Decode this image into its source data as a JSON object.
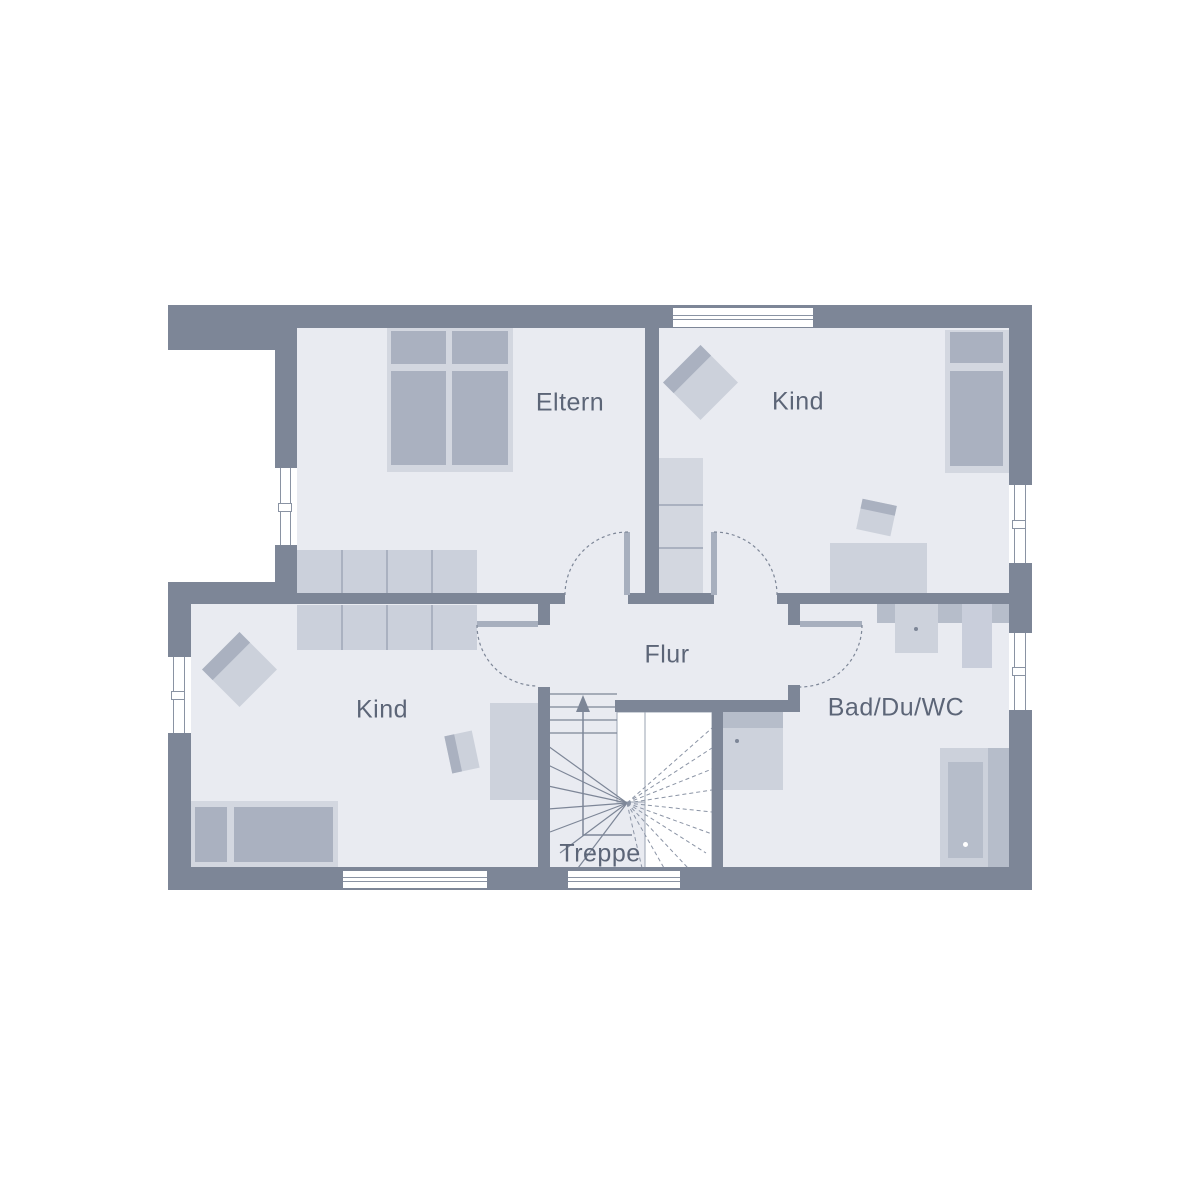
{
  "plan": {
    "type": "floor-plan",
    "rooms": {
      "eltern": {
        "label": "Eltern"
      },
      "kind_top": {
        "label": "Kind"
      },
      "kind_bottom": {
        "label": "Kind"
      },
      "flur": {
        "label": "Flur"
      },
      "bad": {
        "label": "Bad/Du/WC"
      },
      "treppe": {
        "label": "Treppe"
      }
    },
    "furniture": {
      "eltern": [
        "double-bed",
        "wardrobe"
      ],
      "kind_top": [
        "lounge-chair",
        "shelf",
        "single-bed",
        "desk",
        "desk-chair"
      ],
      "kind_bottom": [
        "wardrobe",
        "lounge-chair",
        "single-bed",
        "desk",
        "desk-chair"
      ],
      "bad": [
        "vanity-counter",
        "washbasin",
        "shower-column",
        "wc",
        "bathtub"
      ],
      "treppe": [
        "winder-staircase",
        "direction-up-arrow"
      ]
    },
    "openings": {
      "doors": [
        "eltern-door",
        "kind-top-door",
        "kind-bottom-door",
        "bad-door"
      ],
      "windows": [
        "eltern-left",
        "kind-bottom-left",
        "kind-top-top",
        "kind-top-right",
        "bad-right",
        "kind-bottom-bottom",
        "treppe-bottom"
      ]
    },
    "colors": {
      "background": "#ffffff",
      "wall": "#7d8697",
      "floor": "#e9ebf1",
      "furniture_light": "#d3d7e0",
      "furniture_medium": "#aab1c0",
      "wardrobe": "#cbd0db",
      "fixture_light": "#cdd2dc",
      "fixture_dark": "#b6bdca",
      "door_leaf": "#a7afbe",
      "frame_line": "#8a93a3",
      "label_text": "#5c6577"
    }
  }
}
